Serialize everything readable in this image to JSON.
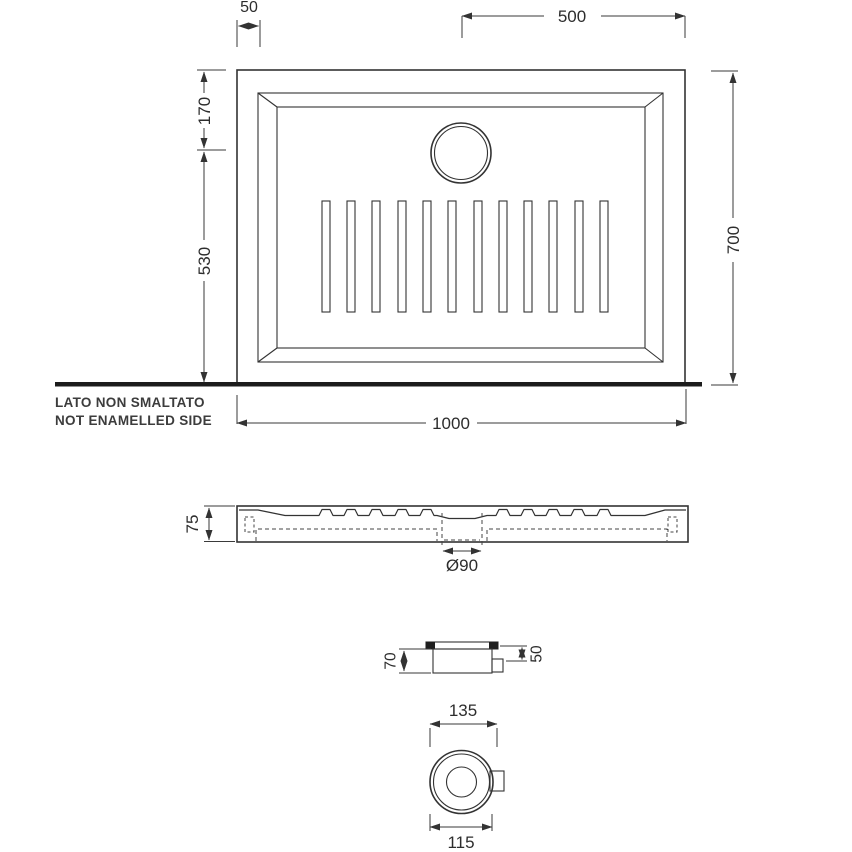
{
  "title": "Shower tray technical drawing",
  "views": {
    "top": {
      "dim_rim_offset": "50",
      "dim_drain_to_right_edge": "500",
      "dim_top_edge_to_drain": "170",
      "dim_drain_to_bottom_edge": "530",
      "dim_depth": "700",
      "dim_width": "1000",
      "note_line1": "LATO NON SMALTATO",
      "note_line2": "NOT ENAMELLED SIDE",
      "slot_count": 12
    },
    "section": {
      "dim_height": "75",
      "dim_drain_hole": "Ø90"
    },
    "drain_side": {
      "dim_trap_height": "70",
      "dim_outlet_height": "50"
    },
    "drain_bottom": {
      "dim_overall_width": "135",
      "dim_flange_diameter": "115"
    }
  },
  "colors": {
    "line": "#333333",
    "text": "#2d2d2d",
    "ground_line": "#1c1c1c",
    "background": "#ffffff"
  }
}
